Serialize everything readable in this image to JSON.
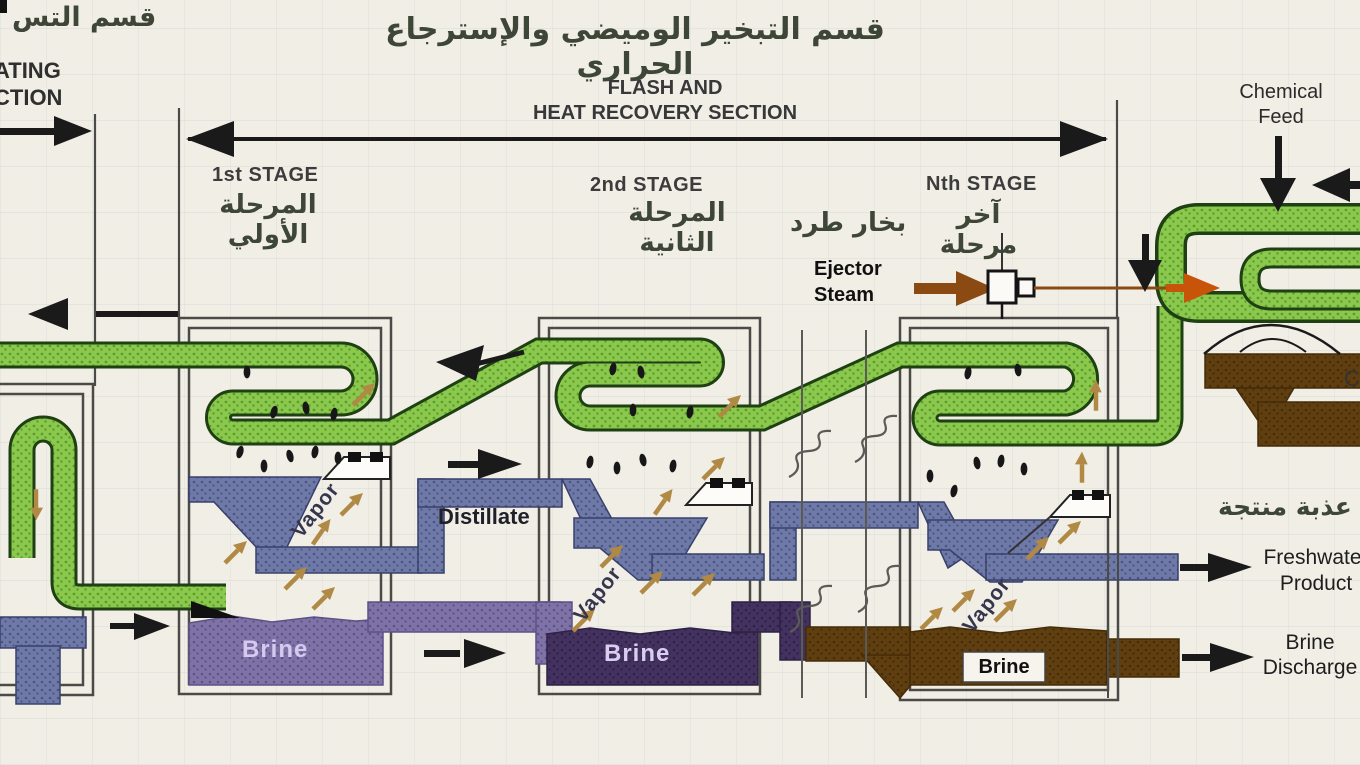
{
  "header": {
    "title_ar": "قسم التبخير الوميضي والإسترجاع الحراري",
    "flash_line1": "FLASH AND",
    "flash_line2": "HEAT RECOVERY SECTION",
    "left_title_ar": "قسم التس",
    "left_line1": "ATING",
    "left_line2": "CTION",
    "chemical_line1": "Chemical",
    "chemical_line2": "Feed"
  },
  "stages": {
    "s1": {
      "label": "1st STAGE",
      "label_ar": "المرحلة الأولي"
    },
    "s2": {
      "label": "2nd STAGE",
      "label_ar": "المرحلة الثانية"
    },
    "sn": {
      "label": "Nth STAGE",
      "label_ar": "آخر مرحلة"
    }
  },
  "flows": {
    "ejector_ar": "بخار طرد",
    "ejector_line1": "Ejector",
    "ejector_line2": "Steam",
    "distillate": "Distillate",
    "vapor": "Vapor",
    "brine": "Brine",
    "freshwater_ar": "مياه عذبة منتجة",
    "freshwater_line1": "Freshwater",
    "freshwater_line2": "Product",
    "discharge_line1": "Brine",
    "discharge_line2": "Discharge",
    "edge_fragment": "C"
  },
  "colors": {
    "pipe_green": "#8cc84e",
    "pipe_green_dot": "#58a02a",
    "distillate_blue": "#6e79a8",
    "distillate_blue_dot": "#4b567f",
    "brine_purple": "#7f72a6",
    "brine_purple_dot": "#5e5187",
    "brine_dark": "#43315f",
    "brine_dark_dot": "#2f2046",
    "brine_brown": "#5f3e10",
    "brine_brown_dot": "#452c09",
    "vapor_tan": "#b08a45",
    "steam_brown": "#8a4a12",
    "steam_orange": "#c8540a",
    "ink": "#1a1a1a"
  }
}
